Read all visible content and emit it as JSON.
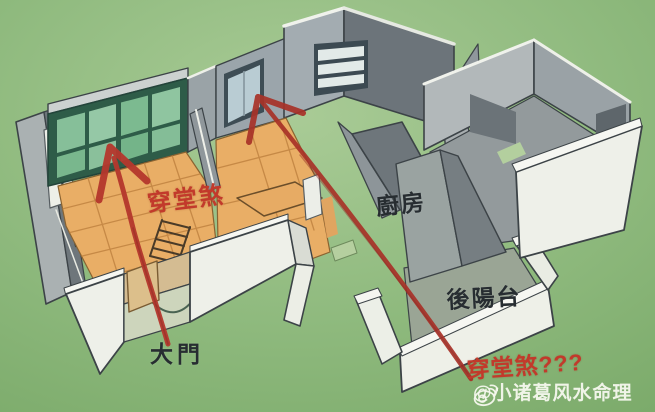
{
  "diagram": {
    "title_hint": "3D cutaway apartment feng-shui diagram",
    "annotations": {
      "sha_living": "穿堂煞",
      "kitchen": "廚房",
      "back_balcony": "後陽台",
      "main_door": "大門",
      "sha_question": "穿堂煞???"
    },
    "watermark": {
      "icon": "weibo-icon",
      "text": "@小诸葛风水命理"
    },
    "palette": {
      "grass_green": "#8fba7e",
      "floor_orange": "#e9ae66",
      "floor_line": "#c08341",
      "window_glass_green": "#8ac09b",
      "window_frame_green": "#2e5c48",
      "wall_gray": "#9aa3a7",
      "wall_dark_gray": "#6c747a",
      "wall_white": "#eef0e9",
      "arrow_red": "#b5382d",
      "label_dark": "#272d31",
      "label_red": "#c23a2b",
      "watermark_color": "#f5f8ee"
    }
  }
}
